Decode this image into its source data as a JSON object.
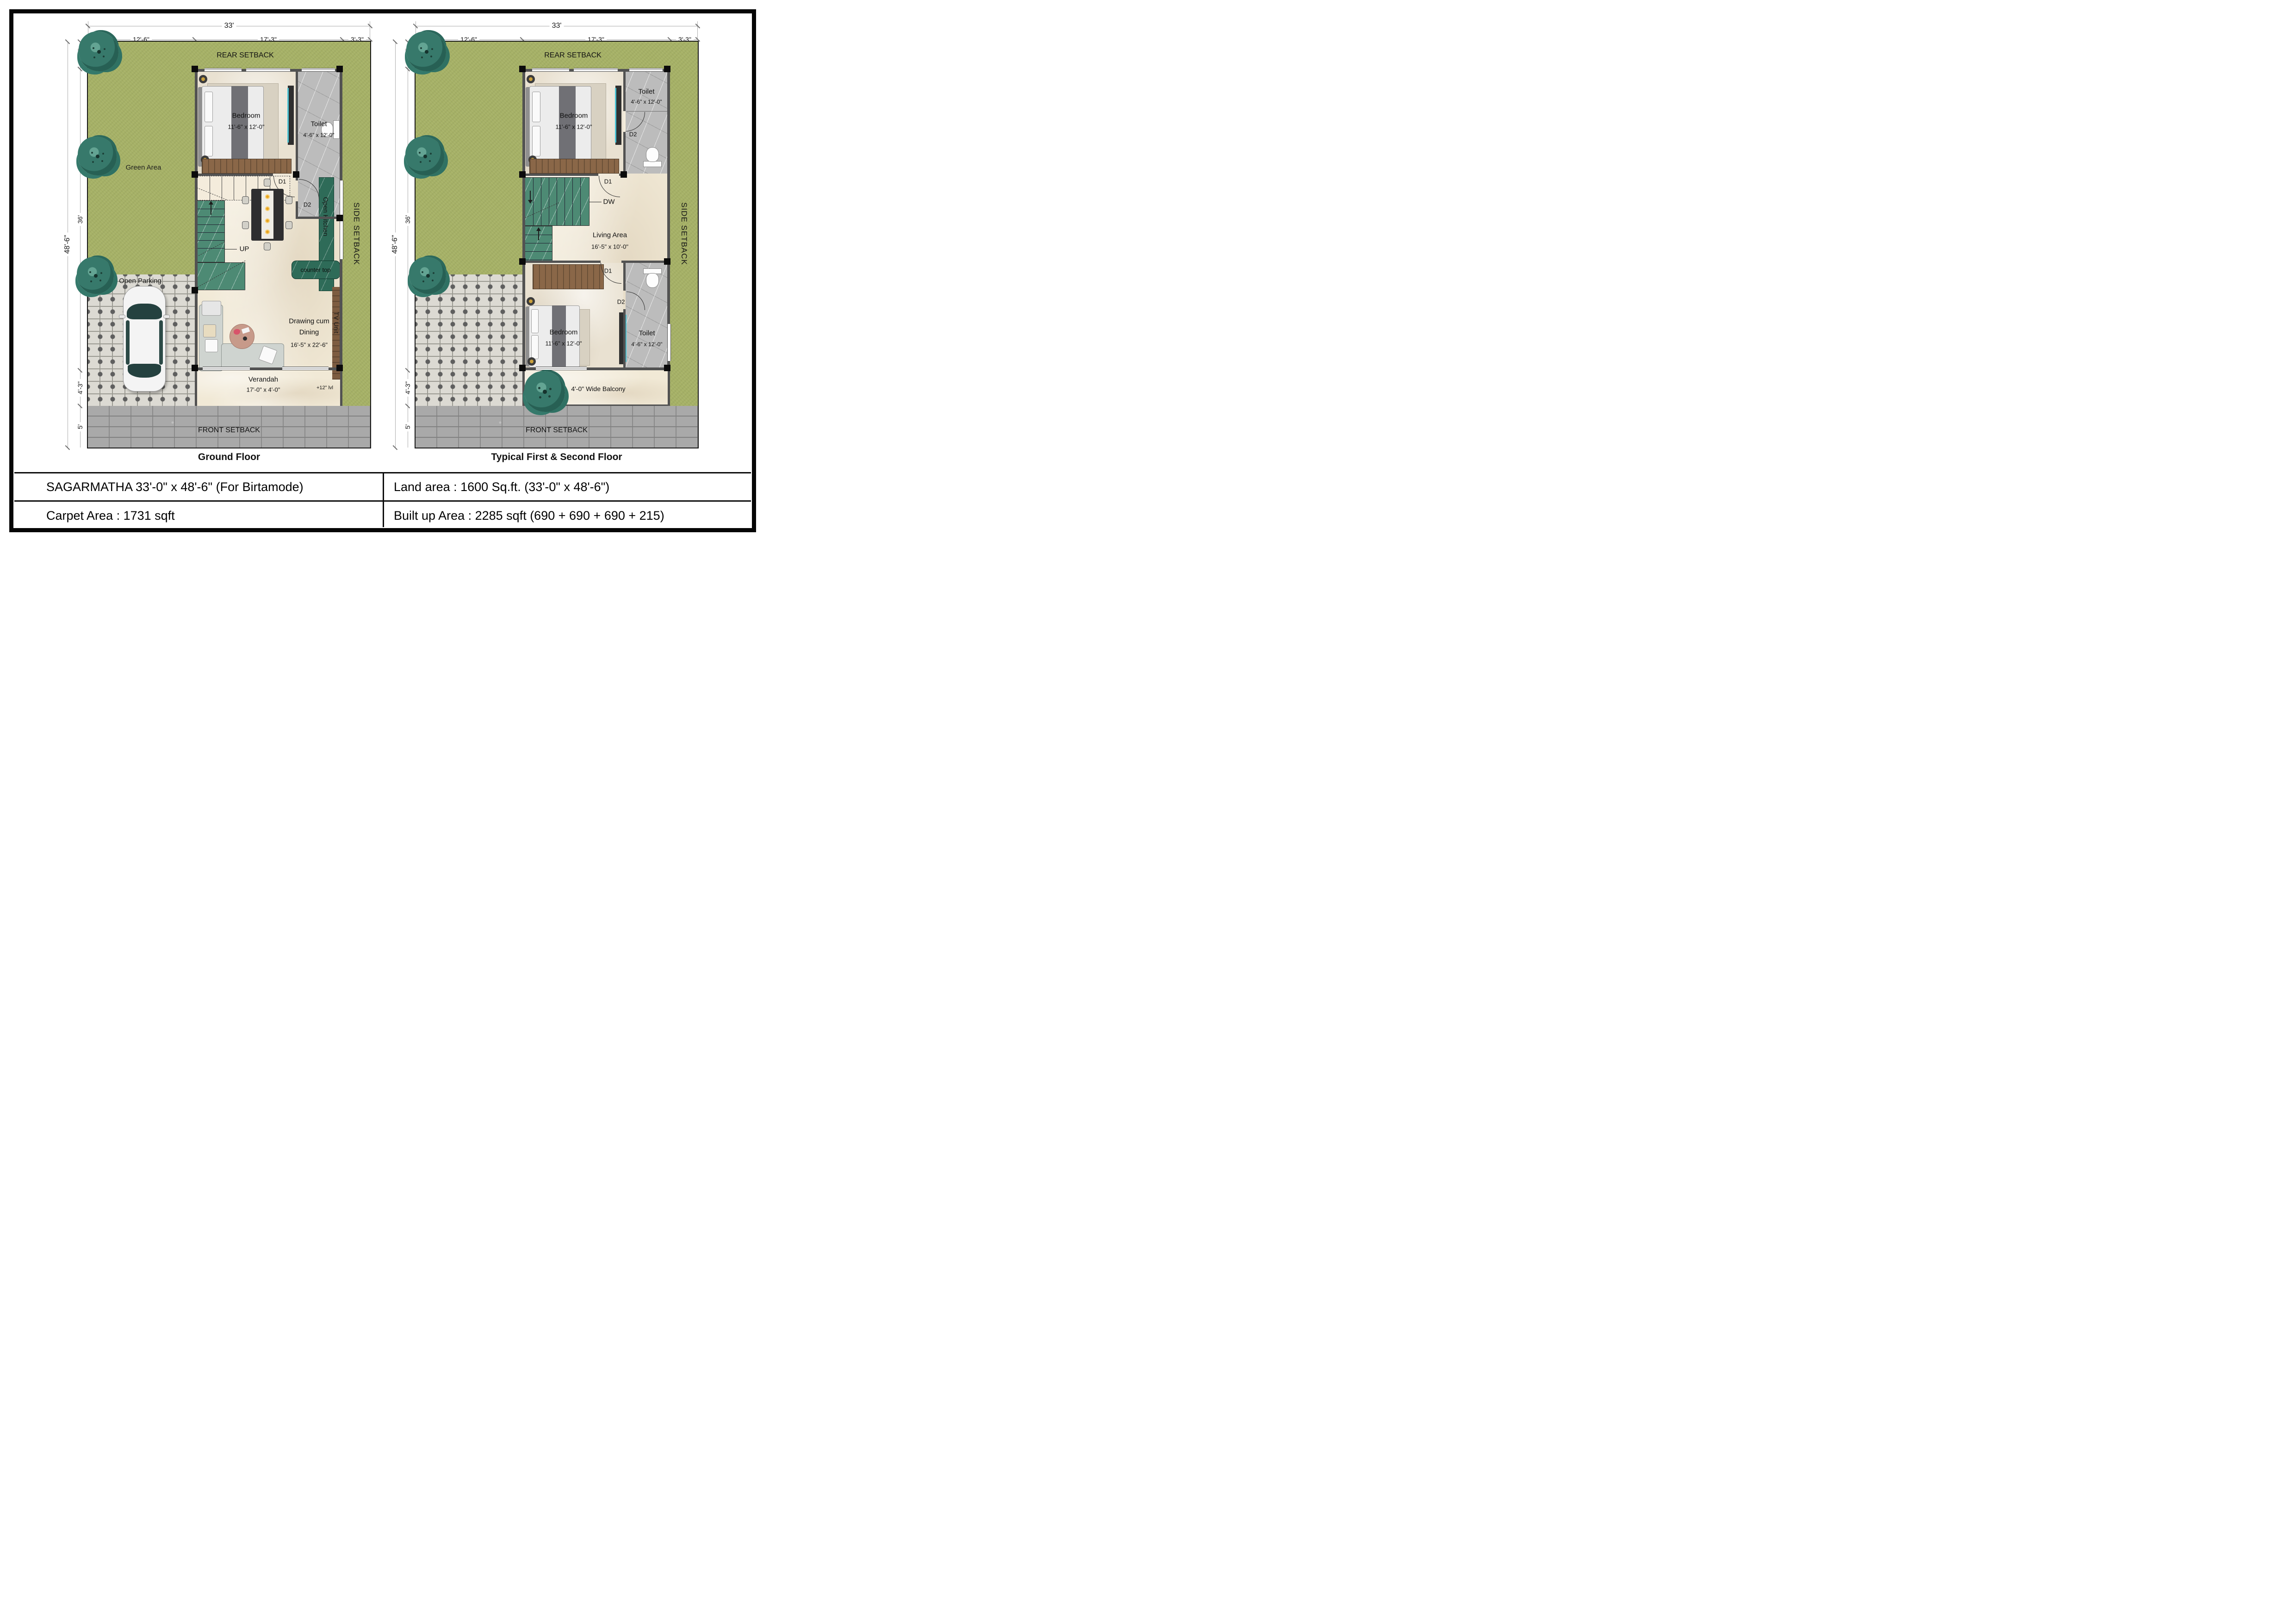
{
  "colors": {
    "lawn_green": "#a6b166",
    "tree_green": "#37796b",
    "floor_cream": "#f1e9d6",
    "toilet_marble_grey": "#bcbcbc",
    "stair_green_marble": "#4d8a74",
    "kitchen_counter_green": "#2e6b58",
    "wall_grey": "#525252",
    "column_black": "#0b0b0b",
    "wood_brown": "#8a6748",
    "paver_grey": "#a9a9a9",
    "parking_tile": "#dcdad3",
    "glass_cyan": "#49c3d4",
    "car_body": "#f4f4f4"
  },
  "title_block": {
    "project_title": "SAGARMATHA 33'-0\" x 48'-6\" (For Birtamode)",
    "land_area": "Land area : 1600 Sq.ft. (33'-0\" x 48'-6\")",
    "carpet_area": "Carpet Area : 1731 sqft",
    "built_up_area": "Built up Area : 2285 sqft (690 + 690 + 690 + 215)"
  },
  "ground_floor": {
    "caption": "Ground Floor",
    "dims": {
      "overall_width": "33'",
      "top_segments": [
        "12'-6\"",
        "17'-3\"",
        "3'-3\""
      ],
      "overall_depth": "48'-6\"",
      "left_segments": [
        "3'-3\"",
        "36'",
        "4'-3\"",
        "5'"
      ]
    },
    "setbacks": {
      "rear": "REAR SETBACK",
      "side": "SIDE SETBACK",
      "front": "FRONT SETBACK"
    },
    "site": {
      "green_area": "Green Area",
      "open_parking": "Open Parking"
    },
    "rooms": {
      "bedroom": {
        "name": "Bedroom",
        "size": "11'-6\" x 12'-0\""
      },
      "toilet": {
        "name": "Toilet",
        "size": "4'-6\" x 12'-0\""
      },
      "drawing_dining": {
        "line1": "Drawing cum",
        "line2": "Dining",
        "size": "16'-5\" x 22'-6\""
      },
      "verandah": {
        "name": "Verandah",
        "size": "17'-0\" x 4'-0\"",
        "level": "+12\" lvl"
      },
      "kitchen": {
        "open_kitchen": "Open Kitchen",
        "counter_top": "counter top"
      },
      "tv_unit": "TV Unit"
    },
    "doors": {
      "d1": "D1",
      "d2": "D2"
    },
    "stairs": {
      "up": "UP"
    }
  },
  "typical_floor": {
    "caption": "Typical First & Second Floor",
    "dims": {
      "overall_width": "33'",
      "top_segments": [
        "12'-6\"",
        "17'-3\"",
        "3'-3\""
      ],
      "overall_depth": "48'-6\"",
      "left_segments": [
        "3'-3\"",
        "36'",
        "4'-3\"",
        "5'"
      ]
    },
    "setbacks": {
      "rear": "REAR SETBACK",
      "side": "SIDE SETBACK",
      "front": "FRONT SETBACK"
    },
    "rooms": {
      "bedroom_top": {
        "name": "Bedroom",
        "size": "11'-6\" x 12'-0\""
      },
      "toilet_top": {
        "name": "Toilet",
        "size": "4'-6\" x 12'-0\""
      },
      "living": {
        "name": "Living Area",
        "size": "16'-5\" x 10'-0\""
      },
      "bedroom_bottom": {
        "name": "Bedroom",
        "size": "11'-6\" x 12'-0\""
      },
      "toilet_bottom": {
        "name": "Toilet",
        "size": "4'-6\" x 12'-0\""
      },
      "balcony": "4'-0\" Wide Balcony"
    },
    "doors": {
      "d1": "D1",
      "d2": "D2"
    },
    "stairs": {
      "up": "UP",
      "dw": "DW"
    }
  }
}
